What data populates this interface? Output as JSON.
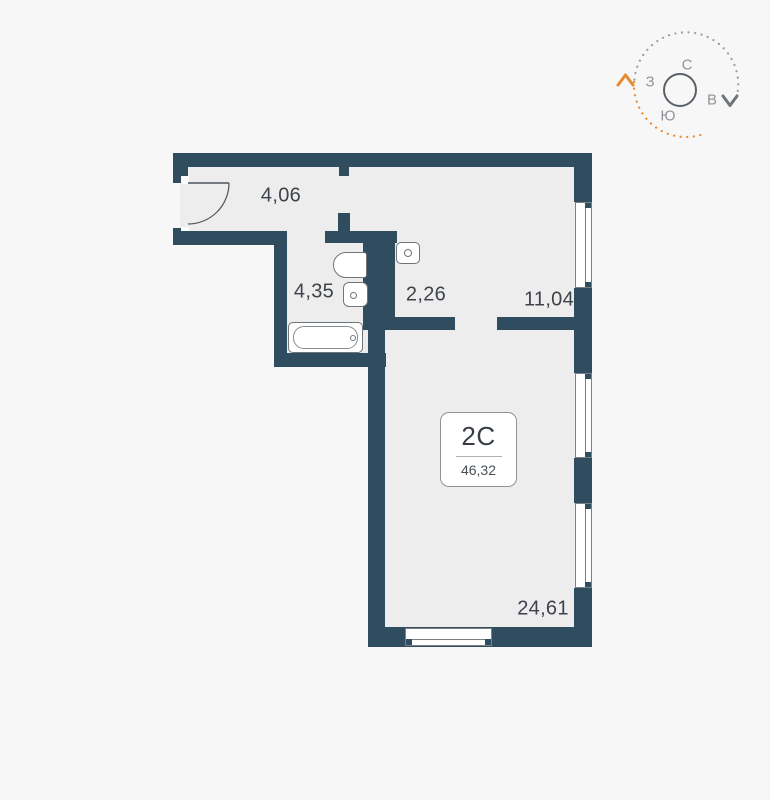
{
  "plan": {
    "badge": {
      "type": "2С",
      "area": "46,32"
    },
    "rooms": [
      {
        "name": "hallway",
        "area": "4,06"
      },
      {
        "name": "bathroom",
        "area": "4,35"
      },
      {
        "name": "corridor",
        "area": "2,26"
      },
      {
        "name": "kitchen-living",
        "area": "11,04"
      },
      {
        "name": "living-room",
        "area": "24,61"
      }
    ]
  },
  "compass": {
    "north": "С",
    "east": "В",
    "south": "Ю",
    "west": "З"
  },
  "colors": {
    "wall": "#2f4d5f",
    "room_fill": "#ededee",
    "background": "#f7f7f8",
    "accent_orange": "#e78a2e",
    "fixture_outline": "#6e757b",
    "label_text": "#3e434a"
  }
}
